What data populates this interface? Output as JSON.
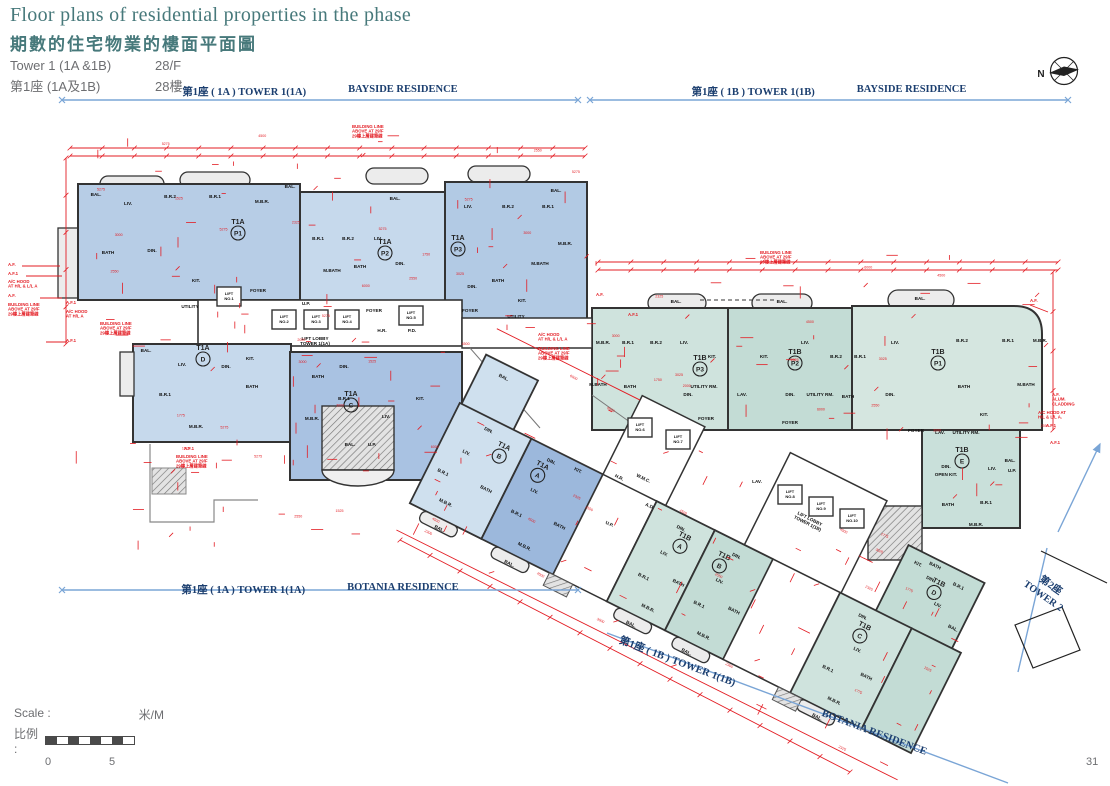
{
  "header": {
    "title_en": "Floor plans of residential properties in the phase",
    "title_zh": "期數的住宅物業的樓面平面圖",
    "tower_en": "Tower 1 (1A &1B)",
    "floor_en": "28/F",
    "tower_zh": "第1座 (1A及1B)",
    "floor_zh": "28樓"
  },
  "compass": {
    "label": "N"
  },
  "boundaries": [
    {
      "zh": "第1座 ( 1A ) TOWER 1(1A)",
      "en": "BAYSIDE RESIDENCE"
    },
    {
      "zh": "第1座 ( 1B ) TOWER 1(1B)",
      "en": "BAYSIDE RESIDENCE"
    },
    {
      "zh": "第1座 ( 1A ) TOWER 1(1A)",
      "en": "BOTANIA RESIDENCE"
    },
    {
      "zh": "第1座 ( 1B ) TOWER 1(1B)",
      "en": "BOTANIA RESIDENCE"
    }
  ],
  "adjacent_tower": {
    "zh": "第2座",
    "en": "TOWER 2"
  },
  "scalebar": {
    "label_en": "Scale :",
    "label_zh": "比例 :",
    "unit": "米/M",
    "start": "0",
    "end": "5"
  },
  "page_number": "31",
  "plan": {
    "colors": {
      "red": "#e31c23",
      "wall": "#333333",
      "boundary_blue": "#7aa5d6",
      "boundary_text": "#1b3e6f",
      "title_teal": "#47797b",
      "gray_text": "#6d6e71",
      "unit_blue": "#b7cde6",
      "unit_blue_dark": "#9cb8dc",
      "unit_teal": "#cfe3dd",
      "unit_teal_dark": "#c3dcd5"
    },
    "units": [
      {
        "tw": "T1A",
        "f": "P1",
        "x": 238,
        "y": 224
      },
      {
        "tw": "T1A",
        "f": "P2",
        "x": 385,
        "y": 244
      },
      {
        "tw": "T1A",
        "f": "P3",
        "x": 458,
        "y": 240
      },
      {
        "tw": "T1A",
        "f": "D",
        "x": 203,
        "y": 350
      },
      {
        "tw": "T1A",
        "f": "C",
        "x": 351,
        "y": 396
      },
      {
        "tw": "T1A",
        "f": "B",
        "x": 499,
        "y": 424,
        "d": 1
      },
      {
        "tw": "T1A",
        "f": "A",
        "x": 542,
        "y": 424,
        "d": 1
      },
      {
        "tw": "T1B",
        "f": "A",
        "x": 701,
        "y": 424,
        "d": 1
      },
      {
        "tw": "T1B",
        "f": "B",
        "x": 745,
        "y": 424,
        "d": 1
      },
      {
        "tw": "T1B",
        "f": "C",
        "x": 902,
        "y": 424,
        "d": 1
      },
      {
        "tw": "T1B",
        "f": "D",
        "x": 949,
        "y": 352,
        "d": 1
      },
      {
        "tw": "T1B",
        "f": "E",
        "x": 962,
        "y": 452
      },
      {
        "tw": "T1B",
        "f": "P3",
        "x": 700,
        "y": 360
      },
      {
        "tw": "T1B",
        "f": "P2",
        "x": 795,
        "y": 354
      },
      {
        "tw": "T1B",
        "f": "P1",
        "x": 938,
        "y": 354
      }
    ],
    "rooms": [
      {
        "t": "BAL.",
        "x": 96,
        "y": 196
      },
      {
        "t": "LIV.",
        "x": 128,
        "y": 205
      },
      {
        "t": "B.R.2",
        "x": 170,
        "y": 198
      },
      {
        "t": "B.R.1",
        "x": 215,
        "y": 198
      },
      {
        "t": "M.B.R.",
        "x": 262,
        "y": 203
      },
      {
        "t": "BATH",
        "x": 108,
        "y": 254
      },
      {
        "t": "DIN.",
        "x": 152,
        "y": 252
      },
      {
        "t": "KIT.",
        "x": 196,
        "y": 282
      },
      {
        "t": "UTILITY",
        "x": 190,
        "y": 308
      },
      {
        "t": "FOYER",
        "x": 258,
        "y": 292
      },
      {
        "t": "BAL.",
        "x": 290,
        "y": 188
      },
      {
        "t": "B.R.1",
        "x": 318,
        "y": 240
      },
      {
        "t": "B.R.2",
        "x": 348,
        "y": 240
      },
      {
        "t": "LIV.",
        "x": 378,
        "y": 240
      },
      {
        "t": "M.BATH",
        "x": 332,
        "y": 272
      },
      {
        "t": "BATH",
        "x": 360,
        "y": 268
      },
      {
        "t": "DIN.",
        "x": 400,
        "y": 265
      },
      {
        "t": "FOYER",
        "x": 374,
        "y": 312
      },
      {
        "t": "U.P.",
        "x": 306,
        "y": 305
      },
      {
        "t": "BAL.",
        "x": 395,
        "y": 200
      },
      {
        "t": "LIV.",
        "x": 468,
        "y": 208
      },
      {
        "t": "B.R.2",
        "x": 508,
        "y": 208
      },
      {
        "t": "B.R.1",
        "x": 548,
        "y": 208
      },
      {
        "t": "M.B.R.",
        "x": 565,
        "y": 245
      },
      {
        "t": "M.BATH",
        "x": 540,
        "y": 265
      },
      {
        "t": "BATH",
        "x": 498,
        "y": 282
      },
      {
        "t": "DIN.",
        "x": 472,
        "y": 288
      },
      {
        "t": "KIT.",
        "x": 522,
        "y": 302
      },
      {
        "t": "UTILITY",
        "x": 516,
        "y": 318
      },
      {
        "t": "FOYER",
        "x": 470,
        "y": 312
      },
      {
        "t": "BAL.",
        "x": 556,
        "y": 192
      },
      {
        "t": "BAL.",
        "x": 146,
        "y": 352
      },
      {
        "t": "LIV.",
        "x": 182,
        "y": 366
      },
      {
        "t": "DIN.",
        "x": 226,
        "y": 368
      },
      {
        "t": "B.R.1",
        "x": 165,
        "y": 396
      },
      {
        "t": "BATH",
        "x": 252,
        "y": 388
      },
      {
        "t": "M.B.R.",
        "x": 196,
        "y": 428
      },
      {
        "t": "KIT.",
        "x": 250,
        "y": 360
      },
      {
        "t": "BATH",
        "x": 318,
        "y": 378
      },
      {
        "t": "DIN.",
        "x": 344,
        "y": 368
      },
      {
        "t": "M.B.R.",
        "x": 312,
        "y": 420
      },
      {
        "t": "B.R.1",
        "x": 344,
        "y": 400
      },
      {
        "t": "LIV.",
        "x": 386,
        "y": 418
      },
      {
        "t": "KIT.",
        "x": 420,
        "y": 400
      },
      {
        "t": "BAL.",
        "x": 350,
        "y": 446
      },
      {
        "t": "U.P.",
        "x": 372,
        "y": 446
      },
      {
        "t": "H.R.",
        "x": 382,
        "y": 332
      },
      {
        "t": "P.D.",
        "x": 412,
        "y": 332
      },
      {
        "t": "M.B.R.",
        "x": 603,
        "y": 344
      },
      {
        "t": "B.R.1",
        "x": 628,
        "y": 344
      },
      {
        "t": "B.R.2",
        "x": 656,
        "y": 344
      },
      {
        "t": "LIV.",
        "x": 684,
        "y": 344
      },
      {
        "t": "M.BATH",
        "x": 598,
        "y": 386
      },
      {
        "t": "BATH",
        "x": 630,
        "y": 388
      },
      {
        "t": "DIN.",
        "x": 688,
        "y": 396
      },
      {
        "t": "KIT.",
        "x": 712,
        "y": 358
      },
      {
        "t": "UTILITY RM.",
        "x": 704,
        "y": 388
      },
      {
        "t": "FOYER",
        "x": 706,
        "y": 420
      },
      {
        "t": "BAL.",
        "x": 676,
        "y": 303
      },
      {
        "t": "LAV.",
        "x": 742,
        "y": 396
      },
      {
        "t": "LIV.",
        "x": 805,
        "y": 344
      },
      {
        "t": "KIT.",
        "x": 764,
        "y": 358
      },
      {
        "t": "B.R.2",
        "x": 836,
        "y": 358
      },
      {
        "t": "B.R.1",
        "x": 860,
        "y": 358
      },
      {
        "t": "DIN.",
        "x": 790,
        "y": 396
      },
      {
        "t": "UTILITY RM.",
        "x": 820,
        "y": 396
      },
      {
        "t": "BATH",
        "x": 848,
        "y": 398
      },
      {
        "t": "FOYER",
        "x": 790,
        "y": 424
      },
      {
        "t": "BAL.",
        "x": 782,
        "y": 303
      },
      {
        "t": "LIV.",
        "x": 895,
        "y": 344
      },
      {
        "t": "B.R.2",
        "x": 962,
        "y": 342
      },
      {
        "t": "B.R.1",
        "x": 1008,
        "y": 342
      },
      {
        "t": "M.B.R.",
        "x": 1040,
        "y": 342
      },
      {
        "t": "M.BATH",
        "x": 1026,
        "y": 386
      },
      {
        "t": "BATH",
        "x": 964,
        "y": 388
      },
      {
        "t": "DIN.",
        "x": 890,
        "y": 396
      },
      {
        "t": "KIT.",
        "x": 984,
        "y": 416
      },
      {
        "t": "FOYER",
        "x": 916,
        "y": 432
      },
      {
        "t": "LAV.",
        "x": 940,
        "y": 434
      },
      {
        "t": "UTILITY RM.",
        "x": 966,
        "y": 434
      },
      {
        "t": "BAL.",
        "x": 920,
        "y": 300
      },
      {
        "t": "DIN.",
        "x": 946,
        "y": 468
      },
      {
        "t": "OPEN KIT.",
        "x": 946,
        "y": 476
      },
      {
        "t": "LIV.",
        "x": 992,
        "y": 470
      },
      {
        "t": "BAL.",
        "x": 1010,
        "y": 462
      },
      {
        "t": "U.P.",
        "x": 1012,
        "y": 472
      },
      {
        "t": "BATH",
        "x": 948,
        "y": 506
      },
      {
        "t": "B.R.1",
        "x": 986,
        "y": 504
      },
      {
        "t": "M.B.R.",
        "x": 976,
        "y": 526
      },
      {
        "t": "BAL.",
        "x": 468,
        "y": 362,
        "d": 1
      },
      {
        "t": "DIN.",
        "x": 478,
        "y": 416,
        "d": 1
      },
      {
        "t": "LIV.",
        "x": 468,
        "y": 446,
        "d": 1
      },
      {
        "t": "B.R.1",
        "x": 456,
        "y": 474,
        "d": 1
      },
      {
        "t": "M.B.R.",
        "x": 472,
        "y": 500,
        "d": 1
      },
      {
        "t": "BATH",
        "x": 502,
        "y": 470,
        "d": 1
      },
      {
        "t": "BAL.",
        "x": 478,
        "y": 526,
        "d": 1
      },
      {
        "t": "DIN.",
        "x": 548,
        "y": 416,
        "d": 1
      },
      {
        "t": "KIT.",
        "x": 576,
        "y": 412,
        "d": 1
      },
      {
        "t": "LIV.",
        "x": 546,
        "y": 450,
        "d": 1
      },
      {
        "t": "B.R.1",
        "x": 540,
        "y": 478,
        "d": 1
      },
      {
        "t": "M.B.R.",
        "x": 562,
        "y": 504,
        "d": 1
      },
      {
        "t": "BATH",
        "x": 584,
        "y": 470,
        "d": 1
      },
      {
        "t": "BAL.",
        "x": 556,
        "y": 526,
        "d": 1
      },
      {
        "t": "W.M.C.",
        "x": 638,
        "y": 390,
        "d": 1
      },
      {
        "t": "H.R.",
        "x": 616,
        "y": 400,
        "d": 1
      },
      {
        "t": "A.D.",
        "x": 656,
        "y": 412,
        "d": 1
      },
      {
        "t": "U.P.",
        "x": 628,
        "y": 446,
        "d": 1
      },
      {
        "t": "DIN.",
        "x": 694,
        "y": 418,
        "d": 1
      },
      {
        "t": "LIV.",
        "x": 690,
        "y": 448,
        "d": 1
      },
      {
        "t": "B.R.1",
        "x": 682,
        "y": 478,
        "d": 1
      },
      {
        "t": "M.B.R.",
        "x": 700,
        "y": 504,
        "d": 1
      },
      {
        "t": "BATH",
        "x": 716,
        "y": 468,
        "d": 1
      },
      {
        "t": "BAL.",
        "x": 692,
        "y": 526,
        "d": 1
      },
      {
        "t": "DIN.",
        "x": 756,
        "y": 418,
        "d": 1
      },
      {
        "t": "LIV.",
        "x": 752,
        "y": 448,
        "d": 1
      },
      {
        "t": "B.R.1",
        "x": 744,
        "y": 478,
        "d": 1
      },
      {
        "t": "M.B.R.",
        "x": 762,
        "y": 504,
        "d": 1
      },
      {
        "t": "BATH",
        "x": 778,
        "y": 468,
        "d": 1
      },
      {
        "t": "BAL.",
        "x": 754,
        "y": 526,
        "d": 1
      },
      {
        "t": "DIN.",
        "x": 896,
        "y": 416,
        "d": 1
      },
      {
        "t": "LIV.",
        "x": 906,
        "y": 448,
        "d": 1
      },
      {
        "t": "B.R.1",
        "x": 888,
        "y": 478,
        "d": 1
      },
      {
        "t": "M.B.R.",
        "x": 908,
        "y": 504,
        "d": 1
      },
      {
        "t": "BATH",
        "x": 926,
        "y": 468,
        "d": 1
      },
      {
        "t": "BAL.",
        "x": 900,
        "y": 526,
        "d": 1
      },
      {
        "t": "KIT.",
        "x": 922,
        "y": 344,
        "d": 1
      },
      {
        "t": "DIN.",
        "x": 940,
        "y": 352,
        "d": 1
      },
      {
        "t": "LIV.",
        "x": 958,
        "y": 372,
        "d": 1
      },
      {
        "t": "B.R.1",
        "x": 968,
        "y": 346,
        "d": 1
      },
      {
        "t": "BATH",
        "x": 938,
        "y": 338,
        "d": 1
      },
      {
        "t": "BAL.",
        "x": 982,
        "y": 386,
        "d": 1
      },
      {
        "t": "LAV.",
        "x": 757,
        "y": 483
      },
      {
        "t": "P.D.",
        "x": 783,
        "y": 492
      }
    ],
    "lifts": [
      {
        "t": "LIFT NO.1",
        "x": 229,
        "y": 299
      },
      {
        "t": "LIFT NO.2",
        "x": 284,
        "y": 322
      },
      {
        "t": "LIFT NO.3",
        "x": 316,
        "y": 322
      },
      {
        "t": "LIFT NO.4",
        "x": 347,
        "y": 322
      },
      {
        "t": "LIFT NO.5",
        "x": 411,
        "y": 318
      },
      {
        "t": "LIFT NO.6",
        "x": 640,
        "y": 430
      },
      {
        "t": "LIFT NO.7",
        "x": 678,
        "y": 442
      },
      {
        "t": "LIFT NO.8",
        "x": 790,
        "y": 497
      },
      {
        "t": "LIFT NO.9",
        "x": 821,
        "y": 509
      },
      {
        "t": "LIFT NO.10",
        "x": 852,
        "y": 521
      }
    ],
    "lobbies": [
      {
        "t": "LIFT LOBBY",
        "t2": "TOWER 1(1A)",
        "x": 315,
        "y": 340
      },
      {
        "t": "LIFT LOBBY",
        "t2": "TOWER 1(1B)",
        "x": 805,
        "y": 352,
        "d": 1
      }
    ],
    "callouts": [
      {
        "t": "A.F.",
        "x": 8,
        "y": 266
      },
      {
        "t": "A.F.1",
        "x": 8,
        "y": 275
      },
      {
        "t": "A/C HOOD\nAT H/L & L/L A",
        "x": 8,
        "y": 283
      },
      {
        "t": "A.F.",
        "x": 8,
        "y": 297
      },
      {
        "t": "BUILDING LINE\nABOVE AT 29/F\n29樓上層建築線",
        "x": 8,
        "y": 306
      },
      {
        "t": "A.F.1",
        "x": 66,
        "y": 304
      },
      {
        "t": "A/C HOOD\nAT H/L A",
        "x": 66,
        "y": 313
      },
      {
        "t": "BUILDING LINE\nABOVE AT 29/F\n29樓上層建築線",
        "x": 100,
        "y": 325
      },
      {
        "t": "A.F.1",
        "x": 66,
        "y": 342
      },
      {
        "t": "BUILDING LINE\nABOVE AT 29/F\n29樓上層建築線",
        "x": 352,
        "y": 128
      },
      {
        "t": "BUILDING LINE\nABOVE AT 29/F\n29樓上層建築線",
        "x": 760,
        "y": 254
      },
      {
        "t": "A.F.",
        "x": 596,
        "y": 296
      },
      {
        "t": "A.F.1",
        "x": 628,
        "y": 316
      },
      {
        "t": "A/C HOOD\nAT H/L & L/L A",
        "x": 538,
        "y": 336
      },
      {
        "t": "BUILDING LINE\nABOVE AT 29/F\n29樓上層建築線",
        "x": 538,
        "y": 350
      },
      {
        "t": "A.F.1",
        "x": 184,
        "y": 450
      },
      {
        "t": "BUILDING LINE\nABOVE AT 29/F\n29樓上層建築線",
        "x": 176,
        "y": 458
      },
      {
        "t": "A.F.",
        "x": 1030,
        "y": 302
      },
      {
        "t": "A.F.\nALUM.\nCLADDING",
        "x": 1052,
        "y": 396
      },
      {
        "t": "A/C HOOD AT\nH/L & L/L A.",
        "x": 1038,
        "y": 414
      },
      {
        "t": "A.F.1",
        "x": 1046,
        "y": 427
      },
      {
        "t": "A.F.1",
        "x": 1050,
        "y": 444
      }
    ],
    "dimension_samples": [
      "2000",
      "3000",
      "1775",
      "1750",
      "2325",
      "2300",
      "3025",
      "4500",
      "5275",
      "6000",
      "1525",
      "2550"
    ]
  }
}
